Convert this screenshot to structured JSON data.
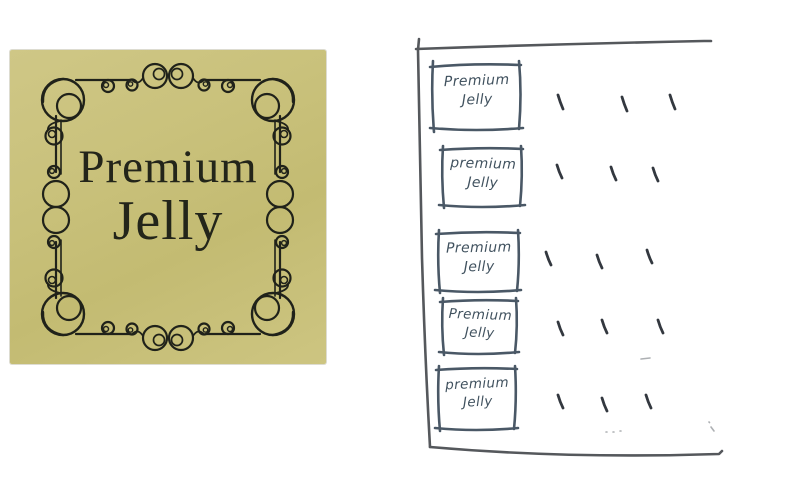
{
  "gold_label": {
    "line1": "Premium",
    "line2": "Jelly",
    "background_color": "#c9c17b",
    "ink_color": "#23251a",
    "frame_style": "ornate-scrollwork"
  },
  "sketch": {
    "ink_color": "#4a5866",
    "outline_color": "#55585c",
    "boxes": [
      {
        "line1": "Premium",
        "line2": "Jelly"
      },
      {
        "line1": "premium",
        "line2": "Jelly"
      },
      {
        "line1": "Premium",
        "line2": "Jelly"
      },
      {
        "line1": "Premium",
        "line2": "Jelly"
      },
      {
        "line1": "premium",
        "line2": "Jelly"
      }
    ],
    "tick_marks": {
      "rows": 5,
      "ticks_per_row": 3
    }
  }
}
